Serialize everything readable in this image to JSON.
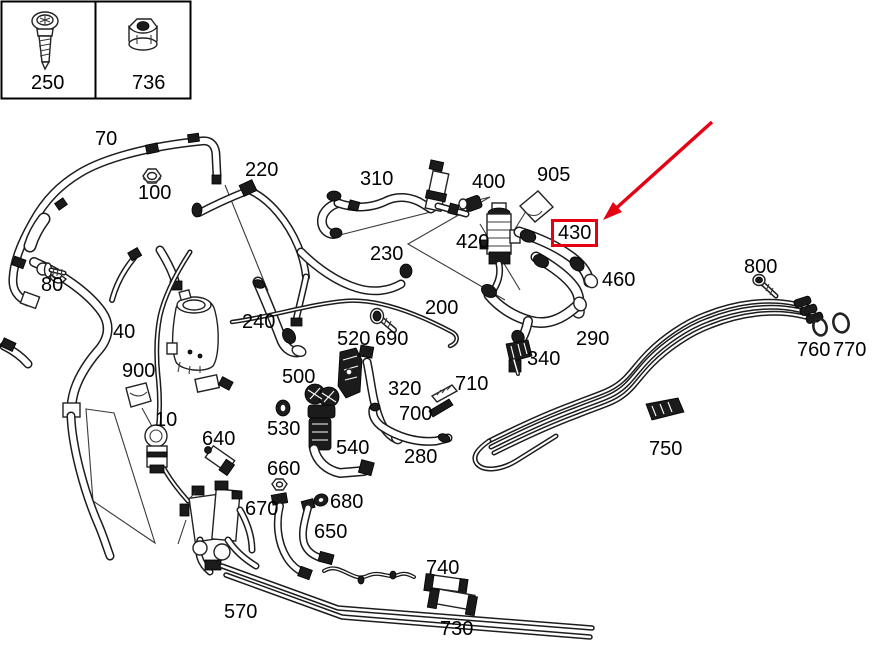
{
  "diagram": {
    "type": "parts-diagram",
    "description": "Vehicle cooling/heater hose and line parts diagram",
    "background": "#ffffff",
    "line_color": "#1c1c1c"
  },
  "annotation": {
    "highlighted_part": "430",
    "color": "#e50012",
    "arrow": {
      "from_x": 712,
      "from_y": 122,
      "to_x": 606,
      "to_y": 217
    }
  },
  "legend": {
    "items": [
      {
        "number": "250",
        "icon": "screw-icon"
      },
      {
        "number": "736",
        "icon": "flange-nut-icon"
      }
    ]
  },
  "labels": [
    {
      "id": "250",
      "text": "250",
      "x": 31,
      "y": 73
    },
    {
      "id": "736",
      "text": "736",
      "x": 132,
      "y": 73
    },
    {
      "id": "70",
      "text": "70",
      "x": 95,
      "y": 129
    },
    {
      "id": "100",
      "text": "100",
      "x": 138,
      "y": 183
    },
    {
      "id": "220",
      "text": "220",
      "x": 245,
      "y": 160
    },
    {
      "id": "310",
      "text": "310",
      "x": 360,
      "y": 169
    },
    {
      "id": "400",
      "text": "400",
      "x": 472,
      "y": 172
    },
    {
      "id": "905",
      "text": "905",
      "x": 537,
      "y": 165
    },
    {
      "id": "420",
      "text": "420",
      "x": 456,
      "y": 232
    },
    {
      "id": "430",
      "text": "430",
      "x": 555,
      "y": 223,
      "highlight": true
    },
    {
      "id": "460",
      "text": "460",
      "x": 602,
      "y": 270
    },
    {
      "id": "230",
      "text": "230",
      "x": 370,
      "y": 244
    },
    {
      "id": "80",
      "text": "80",
      "x": 41,
      "y": 275
    },
    {
      "id": "200",
      "text": "200",
      "x": 425,
      "y": 298
    },
    {
      "id": "800",
      "text": "800",
      "x": 744,
      "y": 257
    },
    {
      "id": "40",
      "text": "40",
      "x": 113,
      "y": 322
    },
    {
      "id": "240",
      "text": "240",
      "x": 242,
      "y": 312
    },
    {
      "id": "520",
      "text": "520",
      "x": 337,
      "y": 329
    },
    {
      "id": "690",
      "text": "690",
      "x": 375,
      "y": 329
    },
    {
      "id": "290",
      "text": "290",
      "x": 576,
      "y": 329
    },
    {
      "id": "340",
      "text": "340",
      "x": 527,
      "y": 349
    },
    {
      "id": "760",
      "text": "760",
      "x": 797,
      "y": 340
    },
    {
      "id": "770",
      "text": "770",
      "x": 833,
      "y": 340
    },
    {
      "id": "900",
      "text": "900",
      "x": 122,
      "y": 361
    },
    {
      "id": "500",
      "text": "500",
      "x": 282,
      "y": 367
    },
    {
      "id": "320",
      "text": "320",
      "x": 388,
      "y": 379
    },
    {
      "id": "710",
      "text": "710",
      "x": 455,
      "y": 374
    },
    {
      "id": "700",
      "text": "700",
      "x": 399,
      "y": 404
    },
    {
      "id": "10",
      "text": "10",
      "x": 155,
      "y": 410
    },
    {
      "id": "530",
      "text": "530",
      "x": 267,
      "y": 419
    },
    {
      "id": "640",
      "text": "640",
      "x": 202,
      "y": 429
    },
    {
      "id": "540",
      "text": "540",
      "x": 336,
      "y": 438
    },
    {
      "id": "280",
      "text": "280",
      "x": 404,
      "y": 447
    },
    {
      "id": "750",
      "text": "750",
      "x": 649,
      "y": 439
    },
    {
      "id": "660",
      "text": "660",
      "x": 267,
      "y": 459
    },
    {
      "id": "680",
      "text": "680",
      "x": 330,
      "y": 492
    },
    {
      "id": "670",
      "text": "670",
      "x": 245,
      "y": 499
    },
    {
      "id": "650",
      "text": "650",
      "x": 314,
      "y": 522
    },
    {
      "id": "740",
      "text": "740",
      "x": 426,
      "y": 558
    },
    {
      "id": "570",
      "text": "570",
      "x": 224,
      "y": 602
    },
    {
      "id": "730",
      "text": "730",
      "x": 440,
      "y": 619
    }
  ]
}
